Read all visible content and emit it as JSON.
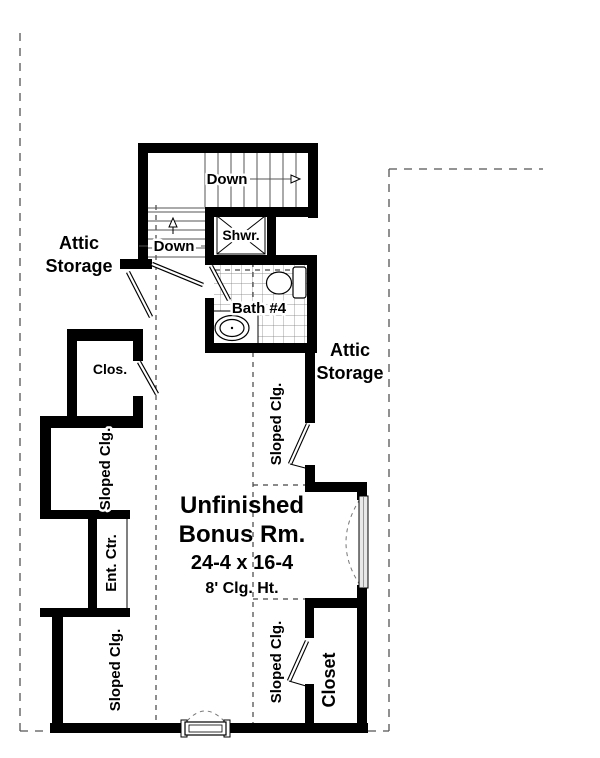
{
  "plan": {
    "title": "Bonus room floor plan",
    "labels": {
      "attic_left_1": "Attic",
      "attic_left_2": "Storage",
      "attic_right_1": "Attic",
      "attic_right_2": "Storage",
      "down_upper": "Down",
      "down_lower": "Down",
      "shower": "Shwr.",
      "bath": "Bath #4",
      "clos_small": "Clos.",
      "sloped_upper_left": "Sloped Clg.",
      "sloped_lower_left": "Sloped Clg.",
      "sloped_upper_right": "Sloped Clg.",
      "sloped_lower_right": "Sloped Clg.",
      "ent_ctr": "Ent. Ctr.",
      "closet_large": "Closet"
    },
    "room": {
      "name_line1": "Unfinished",
      "name_line2": "Bonus Rm.",
      "dimensions": "24-4 x 16-4",
      "ceiling": "8' Clg. Ht."
    },
    "colors": {
      "wall": "#000000",
      "background": "#ffffff",
      "thin_line": "#555555"
    }
  }
}
